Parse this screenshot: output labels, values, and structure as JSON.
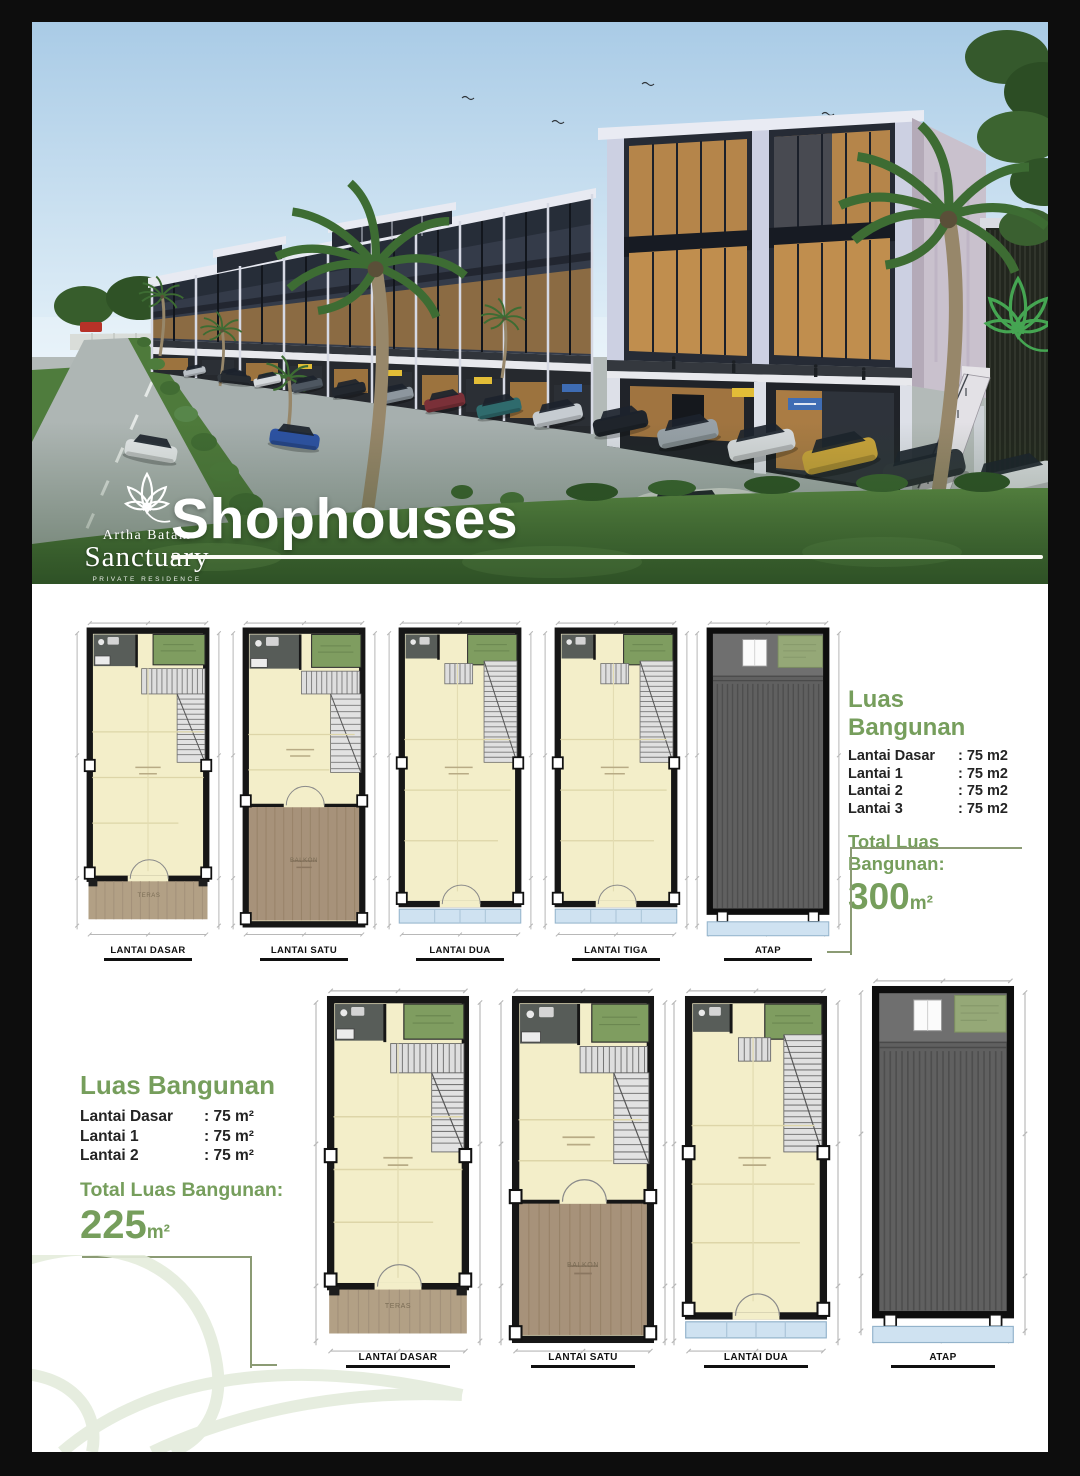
{
  "hero": {
    "title": "Shophouses",
    "brand": {
      "top": "Artha Batam",
      "name": "Sanctuary",
      "tagline": "PRIVATE RESIDENCE"
    }
  },
  "sections": {
    "top": {
      "plan_labels": [
        "LANTAI DASAR",
        "LANTAI SATU",
        "LANTAI DUA",
        "LANTAI TIGA",
        "ATAP"
      ],
      "area": {
        "title": "Luas Bangunan",
        "rows": [
          {
            "label": "Lantai Dasar",
            "value": ": 75 m2"
          },
          {
            "label": "Lantai 1",
            "value": ": 75 m2"
          },
          {
            "label": "Lantai 2",
            "value": ": 75 m2"
          },
          {
            "label": "Lantai 3",
            "value": ": 75 m2"
          }
        ],
        "total_label": "Total Luas Bangunan:",
        "total_value": "300",
        "total_unit": "m²"
      }
    },
    "bottom": {
      "plan_labels": [
        "LANTAI DASAR",
        "LANTAI SATU",
        "LANTAI DUA",
        "ATAP"
      ],
      "area": {
        "title": "Luas Bangunan",
        "rows": [
          {
            "label": "Lantai Dasar",
            "value": ": 75 m²"
          },
          {
            "label": "Lantai 1",
            "value": ": 75 m²"
          },
          {
            "label": "Lantai 2",
            "value": ": 75 m²"
          }
        ],
        "total_label": "Total Luas Bangunan:",
        "total_value": "225",
        "total_unit": "m²"
      }
    }
  },
  "plan_rooms": {
    "teras": "TERAS",
    "balkon": "BALKON"
  },
  "colors": {
    "accent_green": "#769e5c",
    "plan_floor": "#f3eec9",
    "plan_roof": "#606060",
    "canopy_blue": "#cfe2f1",
    "terrace_tan": "#b2a085",
    "balcony_brown": "#a7927a"
  }
}
